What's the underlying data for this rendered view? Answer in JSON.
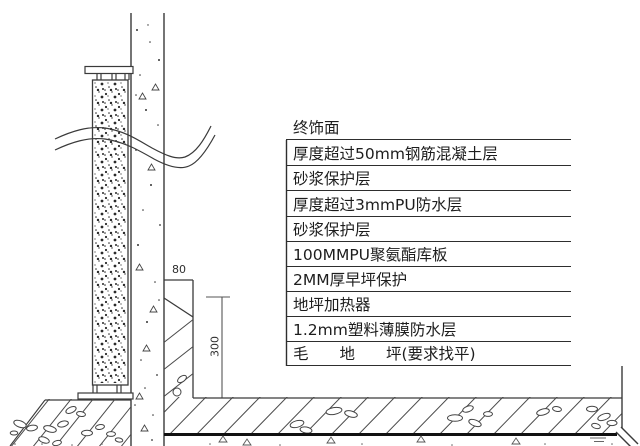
{
  "drawing_type": "wall-floor construction detail section",
  "legend": {
    "layers": [
      "终饰面",
      "厚度超过50mm钢筋混凝土层",
      "砂浆保护层",
      "厚度超过3mmPU防水层",
      "砂浆保护层",
      "100MMPU聚氨酯库板",
      "2MM厚早坪保护",
      "地坪加热器",
      "1.2mm塑料薄膜防水层",
      "毛　　地　　坪(要求找平)"
    ]
  },
  "dimensions": {
    "plinth_width_mm": "80",
    "plinth_height_mm": "300"
  },
  "colors": {
    "line": "#3a3a3a",
    "thick_line": "#111111",
    "hatch": "#4a4a4a",
    "text": "#1d1d1d",
    "background": "#ffffff"
  }
}
